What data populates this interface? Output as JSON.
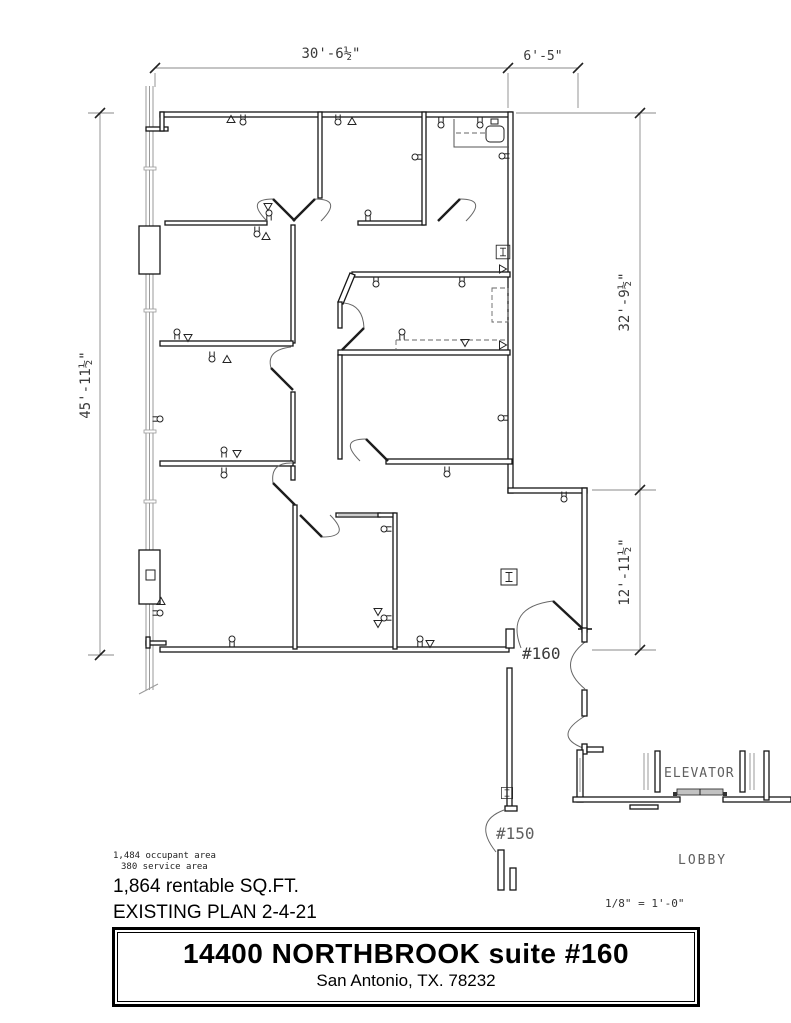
{
  "plan": {
    "dimensions": {
      "top": "30'-6½\"",
      "top_right": "6'-5\"",
      "left": "45'-11½\"",
      "right_upper": "32'-9½\"",
      "right_lower": "12'-11½\""
    },
    "labels": {
      "suite_number": "#160",
      "adjacent_suite": "#150",
      "elevator": "ELEVATOR",
      "lobby": "LOBBY"
    }
  },
  "notes": {
    "occupant_area": "1,484 occupant area",
    "service_area": "380 service area",
    "rentable": "1,864 rentable SQ.FT.",
    "plan_title": "EXISTING PLAN 2-4-21",
    "scale": "1/8\" = 1'-0\""
  },
  "title_block": {
    "line1": "14400 NORTHBROOK suite #160",
    "line2": "San Antonio, TX. 78232"
  },
  "colors": {
    "ink": "#161616",
    "annotation": "#3a3a3a",
    "light_gray": "#9a9a9a"
  }
}
